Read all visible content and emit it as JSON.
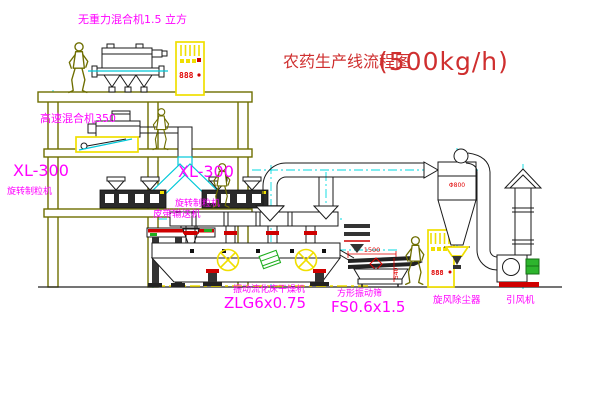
{
  "title": {
    "text": "农药生产线流程图",
    "capacity": "(500kg/h)"
  },
  "equipment_labels": {
    "gravity_mixer": "无重力混合机1.5 立方",
    "high_speed_mixer": "高速混合机350",
    "granulator_model": "XL-300",
    "granulator_name": "旋转制粒机",
    "belt_conveyor": "皮带输送机",
    "fluid_bed_dryer_name": "振动流化床干燥机",
    "fluid_bed_dryer_model": "ZLG6x0.75",
    "vibrating_sieve_name": "方形振动筛",
    "vibrating_sieve_model": "FS0.6x1.5",
    "cyclone_dust_collector": "旋风除尘器",
    "induced_draft_fan": "引风机"
  },
  "dimensions": {
    "sieve_length": "1500",
    "sieve_height": "540",
    "cyclone_diameter": "Φ800"
  },
  "control_cabinet": {
    "display_value": "888"
  },
  "colors": {
    "label": "#ff00ff",
    "title": "#cf2f2f",
    "structure": "#6e6e00",
    "centerline": "#00d9e0",
    "cabinet": "#f0df00",
    "dimension": "#e00000"
  }
}
